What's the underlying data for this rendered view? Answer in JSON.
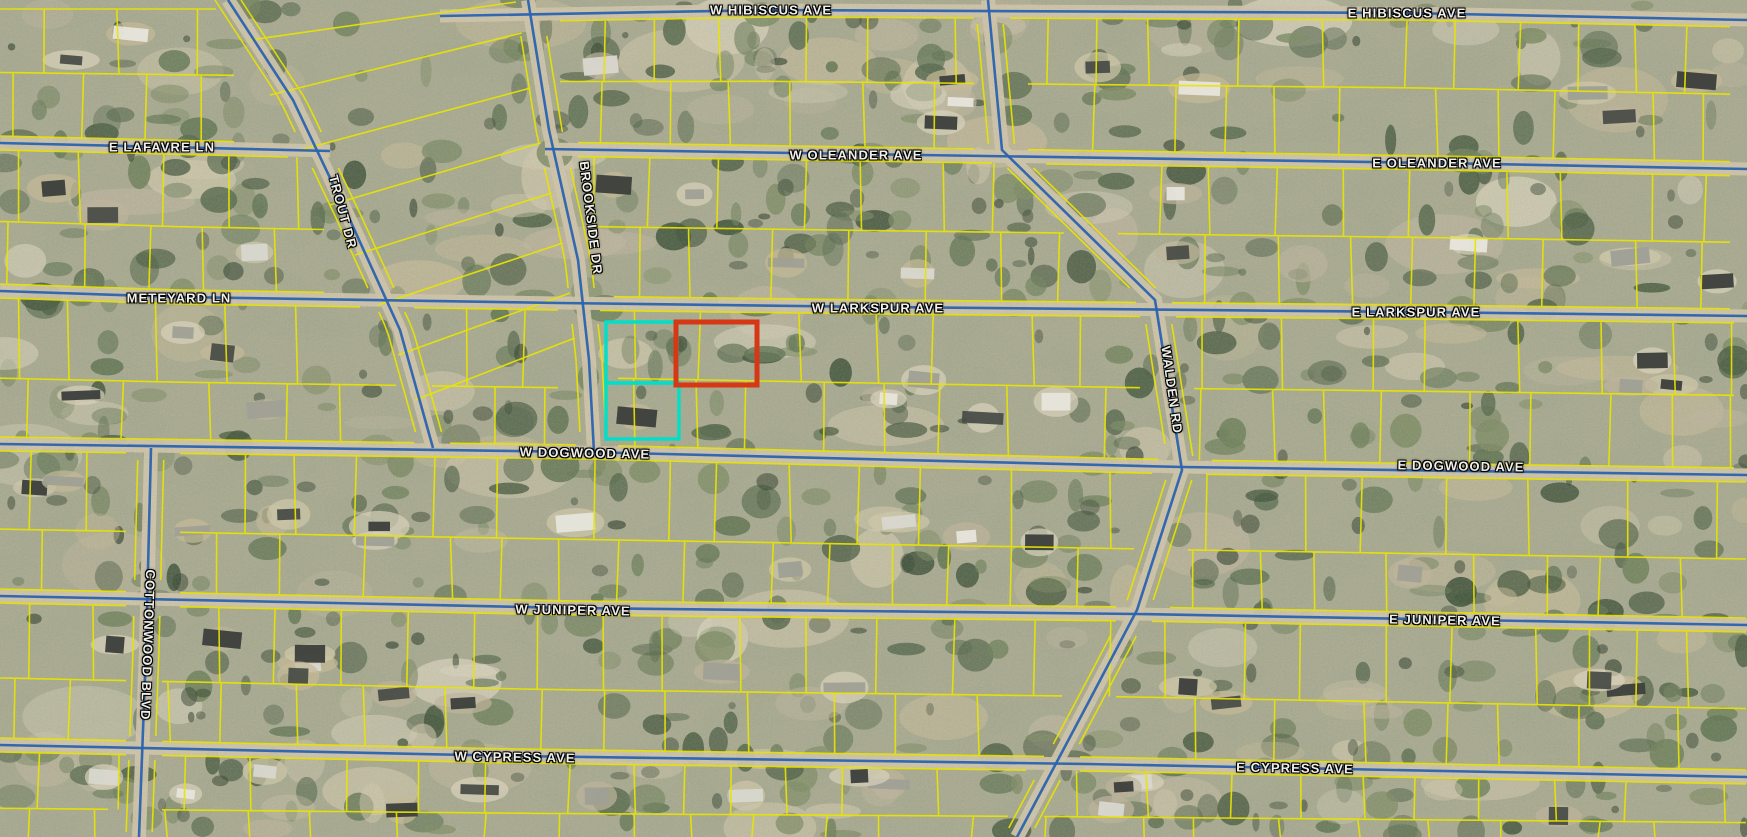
{
  "map": {
    "description": "Aerial parcel map with yellow lot boundaries, blue street centerlines and highlighted parcels (teal and red outlines) near W Larkspur Ave and W Dogwood Ave",
    "street_labels": {
      "w_hibiscus": "W HIBISCUS AVE",
      "e_hibiscus": "E HIBISCUS AVE",
      "e_lafavre": "E LAFAVRE LN",
      "trout": "TROUT DR",
      "w_oleander": "W OLEANDER AVE",
      "e_oleander": "E OLEANDER AVE",
      "meteyard": "METEYARD LN",
      "brookside": "BROOKSIDE DR",
      "w_larkspur": "W LARKSPUR AVE",
      "e_larkspur": "E LARKSPUR AVE",
      "walden": "WALDEN RD",
      "w_dogwood": "W DOGWOOD AVE",
      "e_dogwood": "E DOGWOOD AVE",
      "cottonwood": "COTTONWOOD BLVD",
      "w_juniper": "W JUNIPER AVE",
      "e_juniper": "E JUNIPER AVE",
      "w_cypress": "W CYPRESS AVE",
      "e_cypress": "E CYPRESS AVE"
    },
    "colors": {
      "parcel_line": "#e8e400",
      "road_line": "#2a63b0",
      "road_surface": "#cdc3a6",
      "highlight_teal": "#00dfc8",
      "highlight_red": "#d63815",
      "label_text": "#f0efe8"
    },
    "palette": {
      "ground_base": "#aaa98f",
      "tree_greens": [
        "#3e5137",
        "#495c3f",
        "#55684a",
        "#5f7350",
        "#6d7f58",
        "#7c8a62"
      ],
      "clearing_tans": [
        "#cfc7aa",
        "#c4b997",
        "#d8d2ba",
        "#bdb49b"
      ],
      "building_tones": [
        "#3b3e3b",
        "#4a4d48",
        "#d8d7cf",
        "#e6e5dc",
        "#9fa096"
      ]
    }
  }
}
